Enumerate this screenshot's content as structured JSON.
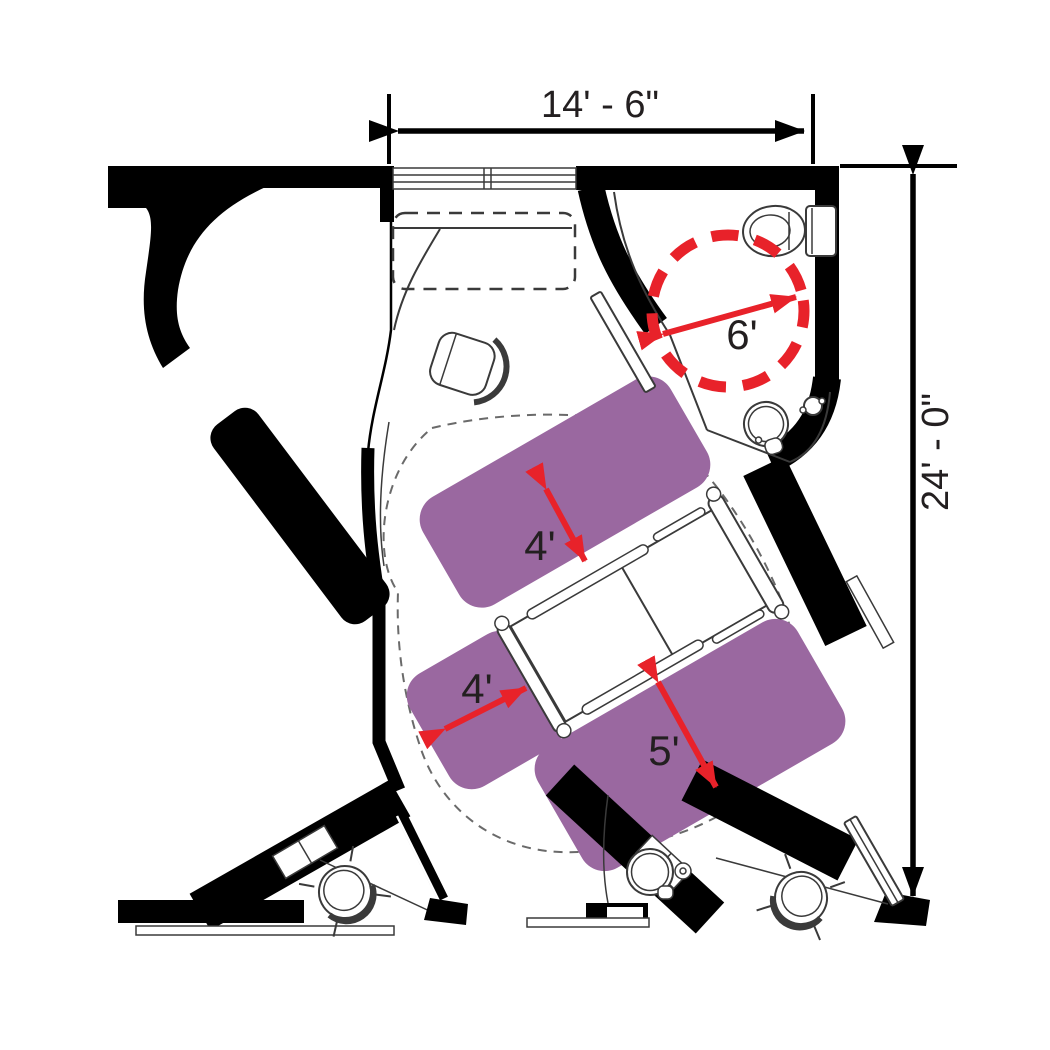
{
  "dimensions": {
    "width": "14' - 6\"",
    "height": "24' - 0\""
  },
  "clearances": {
    "turning_circle": "6'",
    "head_side": "4'",
    "foot_side": "4'",
    "transfer_side": "5'"
  },
  "colors": {
    "purple": "#9a68a0",
    "red": "#e8222a",
    "wall": "#000000",
    "line": "#3a3a3a",
    "dash": "#6a6a6a",
    "text": "#231f20"
  }
}
